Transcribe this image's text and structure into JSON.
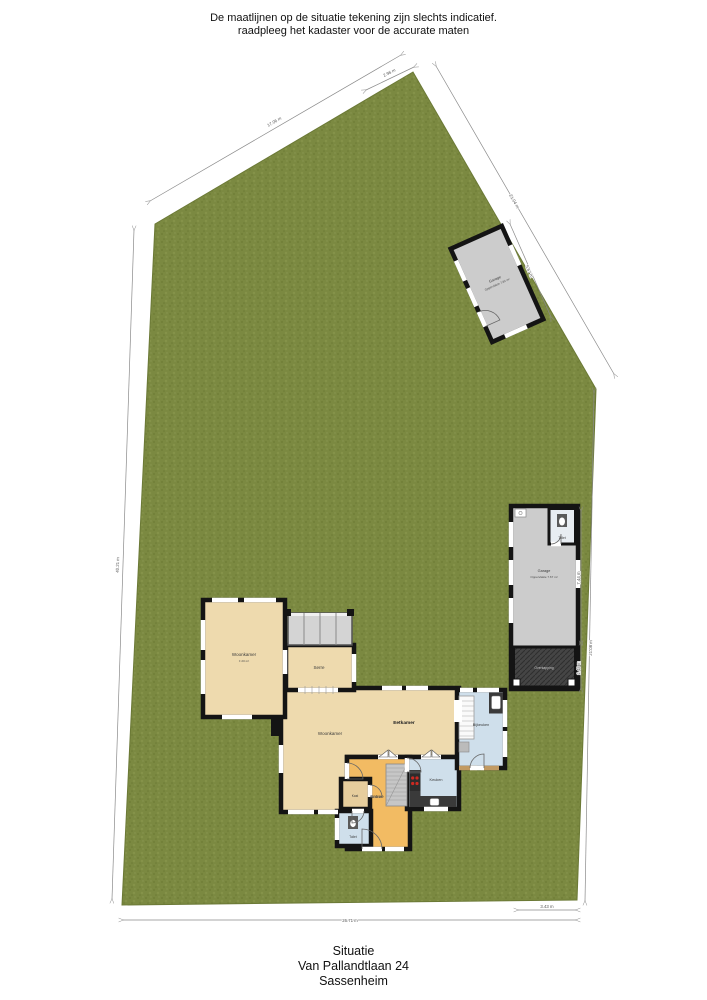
{
  "disclaimer": {
    "line1": "De maatlijnen op de situatie tekening zijn slechts indicatief.",
    "line2": "raadpleeg het kadaster voor de accurate maten"
  },
  "title": {
    "line1": "Situatie",
    "line2": "Van Pallandtlaan 24",
    "line3": "Sassenheim"
  },
  "rooms": {
    "woonkamer_nw": {
      "label": "Woonkamer",
      "sub": "± 20 m²"
    },
    "serre": {
      "label": "Serre"
    },
    "woonkamer": {
      "label": "Woonkamer"
    },
    "eetkamer": {
      "label": "Eetkamer"
    },
    "entree": {
      "label": "Entree"
    },
    "kast": {
      "label": "Kast"
    },
    "toilet": {
      "label": "Toilet"
    },
    "keuken": {
      "label": "Keuken"
    },
    "bijkeuken": {
      "label": "Bijkeuken"
    }
  },
  "garage_top": {
    "label": "Garage",
    "sub": "Oppervlakte 7.84 m²"
  },
  "garage_right": {
    "label": "Garage",
    "sub": "Oppervlakte 7.67 m²",
    "toilet_label": "Toilet",
    "overkapping_label": "Overkapping"
  },
  "dimensions": {
    "top_left": "17.06 m",
    "apex": "2.96 m",
    "diag_full": "21.04 m",
    "garage_top_side": "5.67 m",
    "left_side": "40.21 m",
    "bottom": "26.71 m",
    "bottom_right": "3.43 m",
    "right_side": "21.08 m",
    "garage2_side": "7.44 m",
    "overkapping_side": "2.48 m"
  },
  "colors": {
    "grass": "#7b8941",
    "floor_tan": "#eedaae",
    "floor_orange": "#f2bb63",
    "floor_blue": "#cfdfeb",
    "garage_gray": "#cccccc",
    "overkapping_dark": "#454545",
    "wall": "#141414",
    "counter_dark": "#3a3a3a",
    "stove_red": "#cc2a22"
  }
}
